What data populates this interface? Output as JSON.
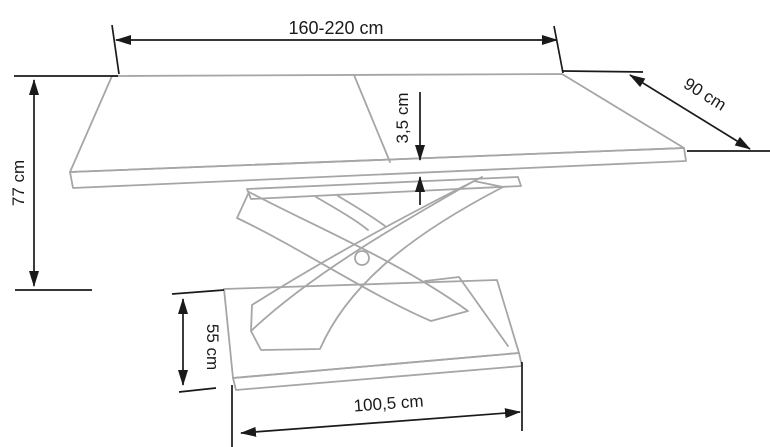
{
  "diagram": {
    "subject": "Dimension drawing of an extendable dining table with curved X-shaped pedestal base",
    "labels": {
      "table_length": "160-220 cm",
      "table_depth": "90 cm",
      "table_height": "77 cm",
      "top_thickness": "3,5 cm",
      "base_depth": "55 cm",
      "base_length": "100,5 cm"
    },
    "colors": {
      "outline_gray": "#a6a6a6",
      "dimension_black": "#1a1a1a",
      "background": "#ffffff"
    }
  }
}
